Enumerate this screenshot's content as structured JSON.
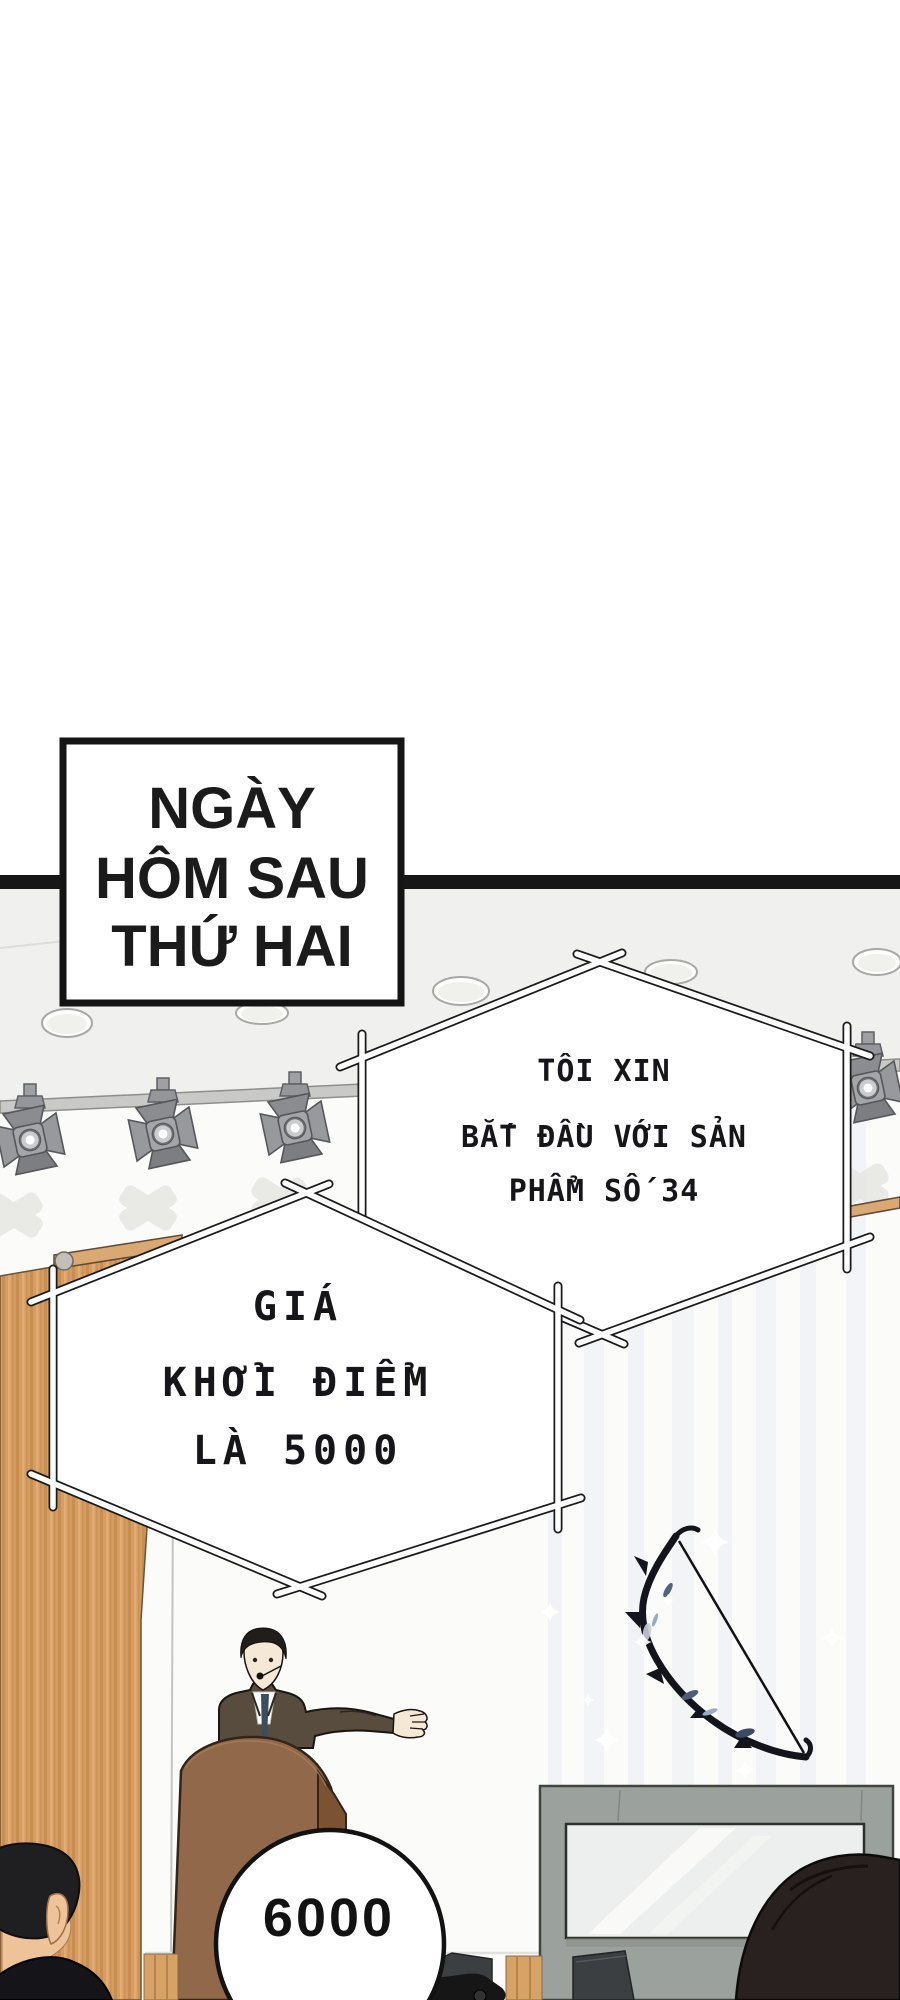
{
  "caption_box": {
    "lines": [
      "NGÀY",
      "HÔM SAU",
      "THỨ HAI"
    ]
  },
  "speech_bubbles": {
    "bubble_product": {
      "lines": [
        "TÔI XIN",
        "BẮT ĐẦU VỚI SẢN",
        "PHẨM SỐ 34"
      ]
    },
    "bubble_price": {
      "lines": [
        "GIÁ",
        "KHỞI ĐIỂM",
        "LÀ 5000"
      ]
    },
    "bubble_bid": {
      "text": "6000"
    }
  },
  "colors": {
    "page_bg": "#ffffff",
    "ink": "#171717",
    "ceiling": "#f0f0ee",
    "wall": "#fbfbf9",
    "wood": "#d69c62",
    "wood_rail": "#d9a873",
    "suit": "#584c3f",
    "tie": "#3e4d5e",
    "skin": "#f5e8d7",
    "hair": "#201d1b",
    "podium": "#91684a",
    "podium_side": "#7b5232",
    "case_frame": "#9ba19c",
    "glass": "#edefee",
    "bubble_fill": "#ffffff"
  }
}
